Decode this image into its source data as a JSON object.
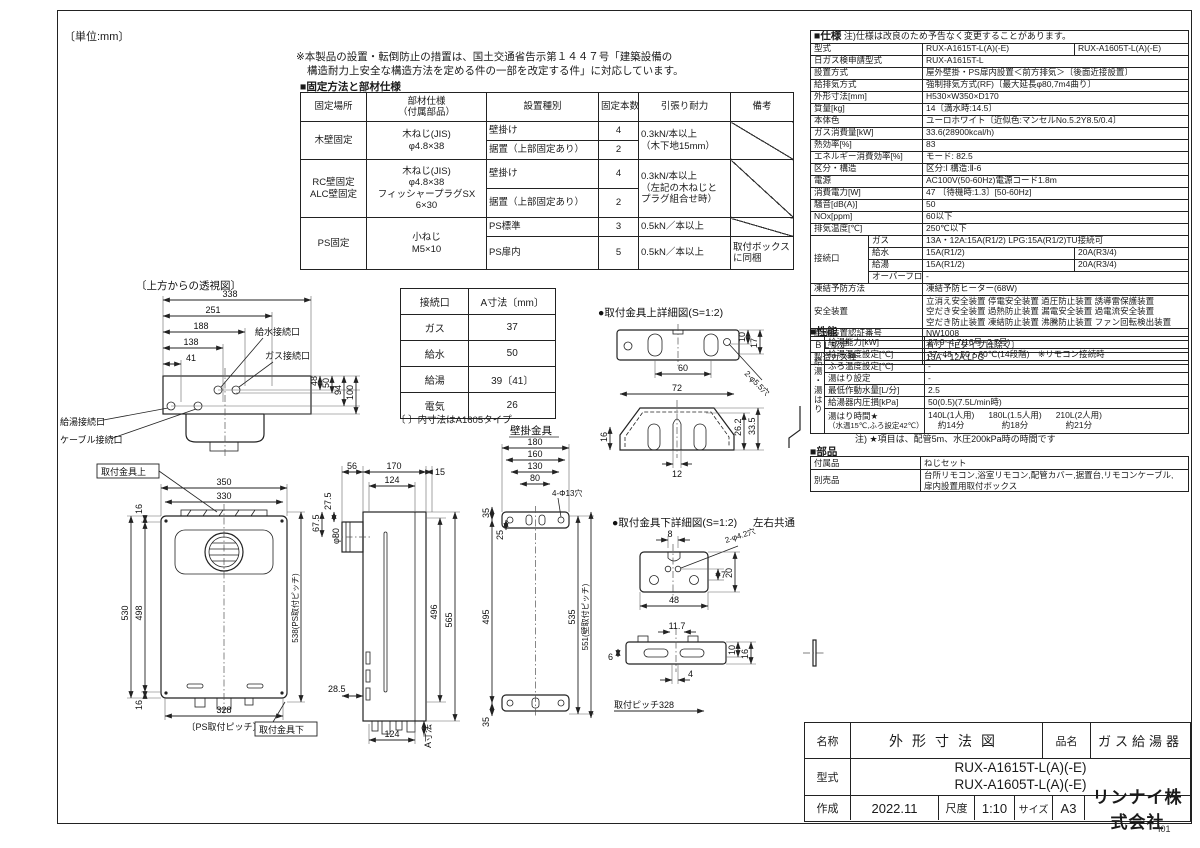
{
  "colors": {
    "ink": "#1a1a1a",
    "bg": "#ffffff"
  },
  "meta": {
    "unit_note": "〔単位:mm〕",
    "corner_mark": "I01"
  },
  "top_note": {
    "line1": "※本製品の設置・転倒防止の措置は、国土交通省告示第１４４７号「建築設備の",
    "line2": "構造耐力上安全な構造方法を定める件の一部を改定する件」に対応しています。"
  },
  "fixing": {
    "section_title": "■固定方法と部材仕様",
    "headers": {
      "place": "固定場所",
      "part1": "部材仕様",
      "part2": "（付属部品）",
      "type": "設置種別",
      "count": "固定本数",
      "strength": "引張り耐力",
      "note": "備考"
    },
    "wood": {
      "place": "木壁固定",
      "part1": "木ねじ(JIS)",
      "part2": "φ4.8×38",
      "type1": "壁掛け",
      "count1": "4",
      "type2": "据置（上部固定あり）",
      "count2": "2",
      "strength1": "0.3kN/本以上",
      "strength2": "（木下地15mm）"
    },
    "rc": {
      "place1": "RC壁固定",
      "place2": "ALC壁固定",
      "part1": "木ねじ(JIS)",
      "part2": "φ4.8×38",
      "part3": "フィッシャープラグSX",
      "part4": "6×30",
      "type1": "壁掛け",
      "count1": "4",
      "type2": "据置（上部固定あり）",
      "count2": "2",
      "strength1": "0.3kN/本以上",
      "strength2": "（左記の木ねじと",
      "strength3": "プラグ組合せ時）"
    },
    "ps": {
      "place": "PS固定",
      "part1": "小ねじ",
      "part2": "M5×10",
      "type1": "PS標準",
      "count1": "3",
      "strength1": "0.5kN／本以上",
      "type2": "PS扉内",
      "count2": "5",
      "strength2": "0.5kN／本以上",
      "note1": "取付ボックス",
      "note2": "に同梱"
    }
  },
  "spec": {
    "section_title": "■仕様",
    "section_note": "注)仕様は改良のため予告なく変更することがあります。",
    "rows": {
      "model": {
        "label": "型式",
        "v1": "RUX-A1615T-L(A)(-E)",
        "v2": "RUX-A1605T-L(A)(-E)"
      },
      "nichigas": {
        "label": "日ガス検申請型式",
        "value": "RUX-A1615T-L"
      },
      "install": {
        "label": "設置方式",
        "value": "屋外壁掛・PS扉内設置＜前方排気＞〔後面近接設置〕"
      },
      "airflow": {
        "label": "給排気方式",
        "value": "強制排気方式(RF)〔最大延長φ80,7m4曲り〕"
      },
      "dimensions": {
        "label": "外形寸法[mm]",
        "value": "H530×W350×D170"
      },
      "weight": {
        "label": "質量[kg]",
        "value": "14〔満水時:14.5〕"
      },
      "color": {
        "label": "本体色",
        "value": "ユーロホワイト〔近似色:マンセルNo.5.2Y8.5/0.4〕"
      },
      "gas_consumption": {
        "label": "ガス消費量[kW]",
        "value": "33.6(28900kcal/h)"
      },
      "efficiency": {
        "label": "熱効率[%]",
        "value": "83"
      },
      "energy_efficiency": {
        "label": "エネルギー消費効率[%]",
        "value": "モード: 82.5"
      },
      "class_structure": {
        "label": "区分・構造",
        "value": "区分:Ⅰ  構造:Ⅱ-6"
      },
      "power": {
        "label": "電源",
        "value": "AC100V(50-60Hz)電源コード1.8m"
      },
      "power_consumption": {
        "label": "消費電力[W]",
        "value": "47 〔待機時:1.3〕[50-60Hz]"
      },
      "noise": {
        "label": "騒音[dB(A)]",
        "value": "50"
      },
      "nox": {
        "label": "NOx[ppm]",
        "value": "60以下"
      },
      "exhaust_temp": {
        "label": "排気温度[℃]",
        "value": "250℃以下"
      },
      "connections": {
        "label": "接続口",
        "gas": {
          "label": "ガス",
          "value": "13A・12A:15A(R1/2) LPG:15A(R1/2)TU接続可"
        },
        "water": {
          "label": "給水",
          "v1": "15A(R1/2)",
          "v2": "20A(R3/4)"
        },
        "hot": {
          "label": "給湯",
          "v1": "15A(R1/2)",
          "v2": "20A(R3/4)"
        },
        "overflow": {
          "label": "オーバーフロー",
          "value": "-"
        }
      },
      "freeze": {
        "label": "凍結予防方法",
        "value": "凍結予防ヒーター(68W)"
      },
      "safety": {
        "label": "安全装置",
        "line1": "立消え安全装置 停電安全装置 過圧防止装置 誘導雷保護装置",
        "line2": "空だき安全装置 過熱防止装置 漏電安全装置 過電流安全装置",
        "line3": "空だき防止装置 凍結防止装置 沸騰防止装置 ファン回転検出装置"
      },
      "water_cert": {
        "label": "給水装置認証番号",
        "value": "NW1008"
      },
      "bl": {
        "label": "ＢＬ認定",
        "value": "有り〔-Eタイプは除く〕"
      },
      "gas_types": {
        "label": "製造ガス種",
        "value": "13A・12A,LPG"
      }
    }
  },
  "performance": {
    "section_title": "■性能",
    "group_label": "給湯・湯はり",
    "rows": {
      "capacity": {
        "label": "給湯能力[kW]",
        "value": "27.9~4.7(16号~2.7号)"
      },
      "temp_setting": {
        "label": "給湯温度設定[℃]",
        "value": "37~48・50・60℃(14段階)　※リモコン接続時"
      },
      "bath_temp": {
        "label": "ふろ温度設定[℃]",
        "value": "-"
      },
      "filling": {
        "label": "湯はり設定",
        "value": "-"
      },
      "min_flow": {
        "label": "最低作動水量[L/分]",
        "value": "2.5"
      },
      "pressure_loss": {
        "label": "給湯器内圧損[kPa]",
        "value": "50(0.5)(7.5L/min時)"
      },
      "fill_time": {
        "label1": "湯はり時間★",
        "label2": "（水温15℃,ふろ設定42℃）",
        "c1s": "140L(1人用)",
        "c1t": "約14分",
        "c2s": "180L(1.5人用)",
        "c2t": "約18分",
        "c3s": "210L(2人用)",
        "c3t": "約21分"
      }
    },
    "note": "注) ★項目は、配管5m、水圧200kPa時の時間です"
  },
  "parts": {
    "section_title": "■部品",
    "accessories": {
      "label": "付属品",
      "value": "ねじセット"
    },
    "optional": {
      "label": "別売品",
      "line1": "台所リモコン,浴室リモコン,配管カバー,据置台,リモコンケーブル,",
      "line2": "扉内設置用取付ボックス"
    }
  },
  "conn_table": {
    "h": [
      "接続口",
      "A寸法〔mm〕"
    ],
    "rows": [
      [
        "ガス",
        "37"
      ],
      [
        "給水",
        "50"
      ],
      [
        "給湯",
        "39〔41〕"
      ],
      [
        "電気",
        "26"
      ]
    ],
    "note": "〔 〕内寸法はA1605タイプ"
  },
  "title_block": {
    "name_label": "名称",
    "name_value": "外形寸法図",
    "product_label": "品名",
    "product_value": "ガス給湯器",
    "model_label": "型式",
    "model_line1": "RUX-A1615T-L(A)(-E)",
    "model_line2": "RUX-A1605T-L(A)(-E)",
    "created_label": "作成",
    "created_value": "2022.11",
    "scale_label": "尺度",
    "scale_value": "1:10",
    "size_label": "サイズ",
    "size_value": "A3",
    "company": "リンナイ株式会社"
  },
  "drawings": {
    "top_view": {
      "title": "〔上方からの透視図〕",
      "labels": {
        "water": "給水接続口",
        "gas": "ガス接続口",
        "hot": "給湯接続口",
        "cable": "ケーブル接続口"
      },
      "dims": {
        "d338": "338",
        "d251": "251",
        "d188": "188",
        "d138": "138",
        "d41": "41",
        "d48": "48",
        "d50": "50",
        "d94": "94",
        "d100": "100"
      }
    },
    "front_view": {
      "labels": {
        "upper_bracket": "取付金具上",
        "lower_bracket": "取付金具下"
      },
      "dims": {
        "d350": "350",
        "d330": "330",
        "d16t": "16",
        "d530": "530",
        "d498": "498",
        "d16b": "16",
        "d328": "328",
        "ps_pitch": "〔PS取付ピッチ〕",
        "d538": "538(PS取付ピッチ)"
      }
    },
    "side_view": {
      "dims": {
        "d56": "56",
        "d170": "170",
        "d15": "15",
        "d124t": "124",
        "d275": "27.5",
        "d80": "φ80",
        "d675": "67.5",
        "d496": "496",
        "d565": "565",
        "d285": "28.5",
        "d124b": "124",
        "a_dim": "A寸法"
      }
    },
    "wall_bracket": {
      "title": "壁掛金具",
      "dims": {
        "d180": "180",
        "d160": "160",
        "d130": "130",
        "d80": "80",
        "holes": "4-Φ13穴",
        "d35t": "35",
        "d25": "25",
        "d495": "495",
        "d35b": "35",
        "d535": "535",
        "wall_pitch": "551(壁取付ピッチ)"
      }
    },
    "upper_detail": {
      "title": "●取付金具上詳細図(S=1:2)",
      "dims": {
        "d10": "10",
        "d17": "17",
        "d60": "60",
        "holes": "2-φ5.5穴",
        "d72": "72",
        "d16": "16",
        "d262": "26.2",
        "d335": "33.5",
        "d12": "12"
      }
    },
    "lower_detail": {
      "title": "●取付金具下詳細図(S=1:2)",
      "title2": "左右共通",
      "dims": {
        "d8": "8",
        "holes": "2-φ4.2穴",
        "d7": "7",
        "d20": "20",
        "d48": "48",
        "d117": "11.7",
        "d10": "10",
        "d16": "16",
        "d6": "6",
        "d4": "4",
        "pitch": "取付ピッチ328"
      }
    }
  }
}
